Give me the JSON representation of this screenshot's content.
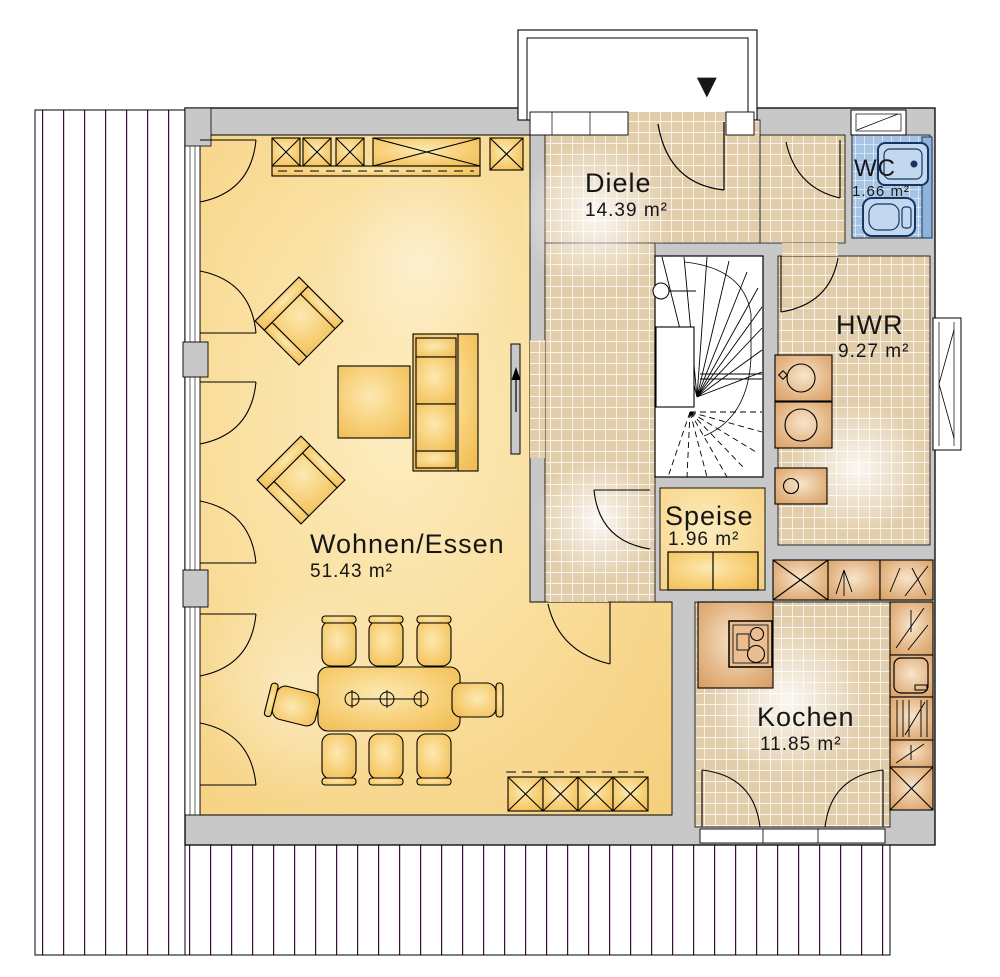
{
  "plan": {
    "rooms": [
      {
        "name": "Diele",
        "area": "14.39 m²"
      },
      {
        "name": "WC",
        "area": "1.66 m²"
      },
      {
        "name": "HWR",
        "area": "9.27 m²"
      },
      {
        "name": "Speise",
        "area": "1.96 m²"
      },
      {
        "name": "Wohnen/Essen",
        "area": "51.43 m²"
      },
      {
        "name": "Kochen",
        "area": "11.85 m²"
      }
    ],
    "entrance_marker": "▼",
    "colors": {
      "wall": "#C8C8C8",
      "living_floor": "#F8DA93",
      "tile_floor": "#E2CDAA",
      "wc_tile": "#A7C4E4",
      "furniture": "#F6C869",
      "kitchen_counter": "#E0B07E",
      "deck_line": "#3A0D3A"
    }
  }
}
